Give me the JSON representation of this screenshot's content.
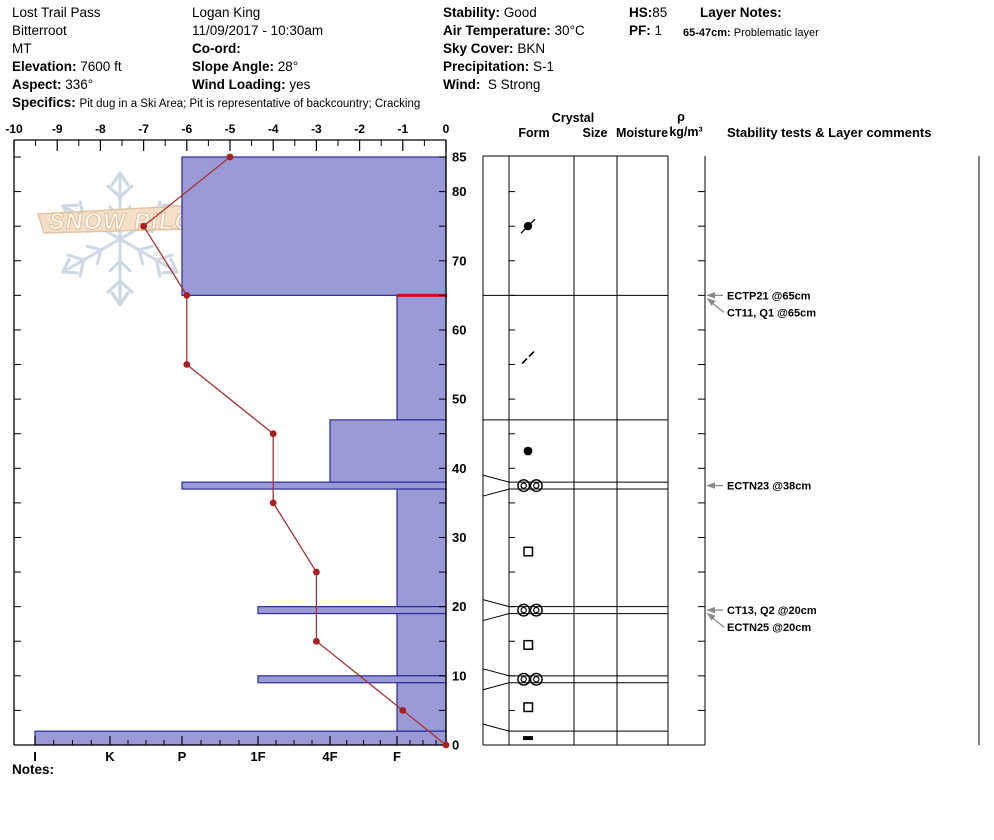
{
  "header": {
    "site": {
      "name": "Lost Trail Pass",
      "range": "Bitterroot",
      "state": "MT",
      "elevation_label": "Elevation:",
      "elevation": "7600 ft",
      "aspect_label": "Aspect:",
      "aspect": "336°",
      "specifics_label": "Specifics:",
      "specifics": "Pit dug in a Ski Area; Pit is representative of backcountry; Cracking"
    },
    "observer": {
      "name": "Logan King",
      "datetime": "11/09/2017 - 10:30am",
      "coord_label": "Co-ord:",
      "coord": "",
      "slope_label": "Slope Angle:",
      "slope": "28°",
      "wind_loading_label": "Wind Loading:",
      "wind_loading": "yes"
    },
    "weather": {
      "stability_label": "Stability:",
      "stability": "Good",
      "air_temp_label": "Air Temperature:",
      "air_temp": "30°C",
      "sky_label": "Sky Cover:",
      "sky": "BKN",
      "precip_label": "Precipitation:",
      "precip": "S-1",
      "wind_label": "Wind:",
      "wind": "S Strong"
    },
    "totals": {
      "hs_label": "HS:",
      "hs": "85",
      "pf_label": "PF:",
      "pf": "1"
    },
    "layer_notes": {
      "label": "Layer Notes:",
      "items": [
        {
          "range": "65-47cm:",
          "note": "Problematic layer"
        }
      ]
    }
  },
  "watermark": {
    "text": "SNOW PILOT"
  },
  "notes_label": "Notes:",
  "chart_data": {
    "type": "snow-pit-profile",
    "temperature_axis": {
      "position": "top",
      "min": -10,
      "max": 0,
      "major_ticks": [
        -10,
        -9,
        -8,
        -7,
        -6,
        -5,
        -4,
        -3,
        -2,
        -1,
        0
      ]
    },
    "hardness_axis": {
      "position": "bottom",
      "labels": [
        "I",
        "K",
        "P",
        "1F",
        "4F",
        "F"
      ]
    },
    "depth_axis": {
      "units": "cm",
      "total_depth": 85,
      "labels": [
        85,
        80,
        70,
        60,
        50,
        40,
        30,
        20,
        10,
        0
      ]
    },
    "temperature_profile": [
      {
        "depth_cm": 85,
        "temp_c": -5
      },
      {
        "depth_cm": 75,
        "temp_c": -7
      },
      {
        "depth_cm": 65,
        "temp_c": -6
      },
      {
        "depth_cm": 55,
        "temp_c": -6
      },
      {
        "depth_cm": 45,
        "temp_c": -4
      },
      {
        "depth_cm": 35,
        "temp_c": -4
      },
      {
        "depth_cm": 25,
        "temp_c": -3
      },
      {
        "depth_cm": 15,
        "temp_c": -3
      },
      {
        "depth_cm": 5,
        "temp_c": -1
      },
      {
        "depth_cm": 0,
        "temp_c": 0
      }
    ],
    "layers": [
      {
        "top_cm": 85,
        "bottom_cm": 65,
        "hardness": "P"
      },
      {
        "top_cm": 65,
        "bottom_cm": 47,
        "hardness": "F",
        "problematic": true
      },
      {
        "top_cm": 47,
        "bottom_cm": 38,
        "hardness": "4F"
      },
      {
        "top_cm": 38,
        "bottom_cm": 37,
        "hardness": "P"
      },
      {
        "top_cm": 37,
        "bottom_cm": 20,
        "hardness": "F"
      },
      {
        "top_cm": 20,
        "bottom_cm": 19,
        "hardness": "1F"
      },
      {
        "top_cm": 19,
        "bottom_cm": 10,
        "hardness": "F"
      },
      {
        "top_cm": 10,
        "bottom_cm": 9,
        "hardness": "1F"
      },
      {
        "top_cm": 9,
        "bottom_cm": 2,
        "hardness": "F"
      },
      {
        "top_cm": 2,
        "bottom_cm": 0,
        "hardness": "I"
      }
    ],
    "grain_symbols": [
      {
        "depth_cm": 75,
        "form": "decomposing-fragments"
      },
      {
        "depth_cm": 56,
        "form": "broken-dashes"
      },
      {
        "depth_cm": 42.5,
        "form": "rounded-grains"
      },
      {
        "depth_cm": 37.5,
        "form": "melt-freeze-crust"
      },
      {
        "depth_cm": 28,
        "form": "facets"
      },
      {
        "depth_cm": 19.5,
        "form": "melt-freeze-crust"
      },
      {
        "depth_cm": 14.5,
        "form": "facets"
      },
      {
        "depth_cm": 9.5,
        "form": "melt-freeze-crust"
      },
      {
        "depth_cm": 5.5,
        "form": "facets"
      },
      {
        "depth_cm": 1,
        "form": "ice-layer"
      }
    ],
    "table_headers": {
      "crystal": "Crystal",
      "form": "Form",
      "size": "Size",
      "moisture": "Moisture",
      "rho": "ρ",
      "rho_units": "kg/m³",
      "stability": "Stability tests & Layer comments"
    },
    "stability_tests": [
      {
        "text": "ECTP21 @65cm",
        "depth_cm": 65,
        "arrow": "horizontal"
      },
      {
        "text": "CT11, Q1 @65cm",
        "depth_cm": 65,
        "arrow": "diagonal"
      },
      {
        "text": "ECTN23 @38cm",
        "depth_cm": 38,
        "arrow": "horizontal"
      },
      {
        "text": "CT13, Q2 @20cm",
        "depth_cm": 20,
        "arrow": "horizontal"
      },
      {
        "text": "ECTN25 @20cm",
        "depth_cm": 20,
        "arrow": "diagonal"
      }
    ],
    "colors": {
      "layer_fill": "#9a9ad6",
      "layer_border": "#2a2aa0",
      "temp_line": "#a83232",
      "temp_point": "#aa2020",
      "problem_marker": "#cc1111",
      "grid": "#000000",
      "arrow": "#8a8a8a",
      "watermark_flake": "#ccd8e4",
      "watermark_banner": "#f4dfc8",
      "watermark_banner_border": "#e2c5a4"
    }
  }
}
